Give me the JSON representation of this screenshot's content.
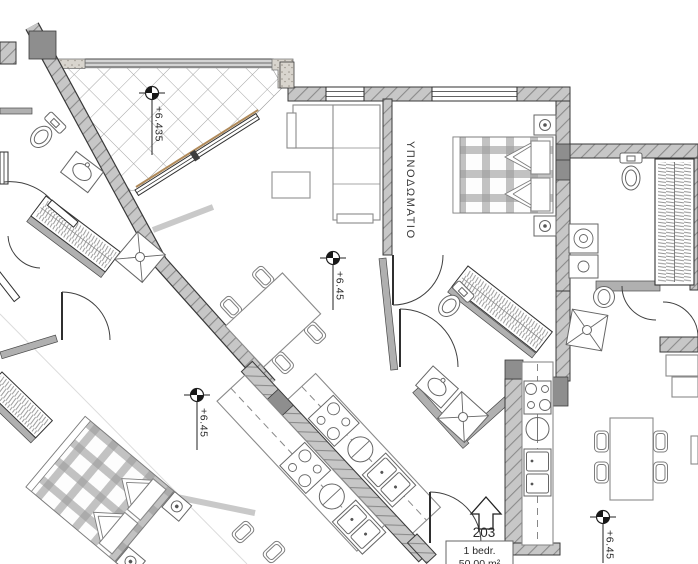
{
  "plan": {
    "unit": {
      "number": "203",
      "type": "1 bedr.",
      "area": "50.00 m²"
    },
    "rooms": {
      "bedroom_label": "ΥΠΝΟΔΩΜΑΤΙΟ"
    },
    "elevations": {
      "balcony": "+6.435",
      "living": "+6.45",
      "left_apartment": "+6.45",
      "right_apartment": "+6.45"
    },
    "colors": {
      "background": "#ffffff",
      "wall_fill": "#c7c7c7",
      "wall_hatch_line": "#8b8b8b",
      "wall_outline": "#3a3a3a",
      "thin_wall_fill": "#b0b0b0",
      "furniture_line": "#8a8a8a",
      "text": "#2b2b2b",
      "wood_accent": "#b08a5a"
    }
  }
}
